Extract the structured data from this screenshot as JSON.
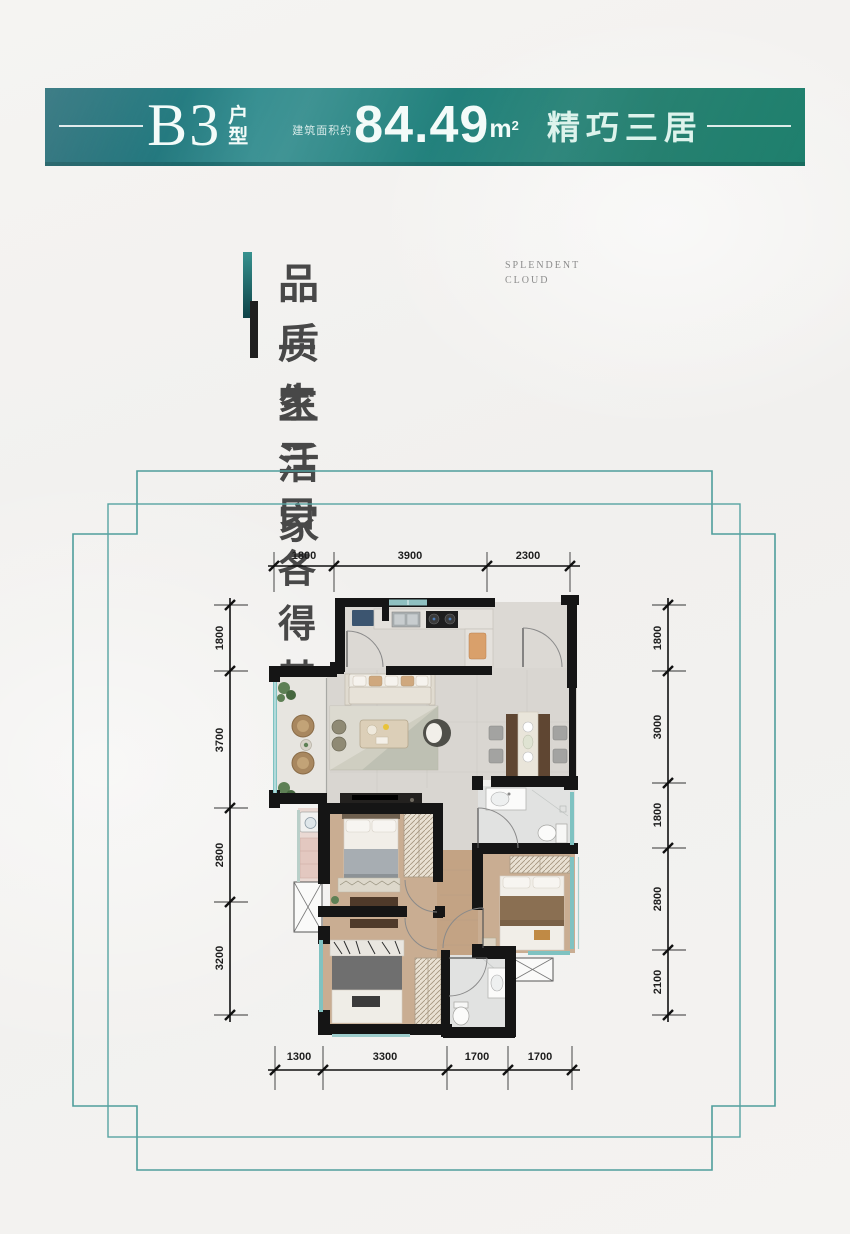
{
  "banner": {
    "unit": "B3",
    "unit_type_top": "户",
    "unit_type_bottom": "型",
    "area_prefix": "建筑面积约",
    "area_value": "84.49",
    "area_unit": "m",
    "area_sup": "2",
    "tagline": "精巧三居"
  },
  "headline": {
    "title": "品质生活家",
    "subtitle_en_line1": "SPLENDENT",
    "subtitle_en_line2": "CLOUD",
    "subtitle": "一家三口各得其乐"
  },
  "floorplan": {
    "dimensions": {
      "top": [
        "1800",
        "3900",
        "2300"
      ],
      "bottom": [
        "1300",
        "3300",
        "1700",
        "1700"
      ],
      "left": [
        "1800",
        "3700",
        "2800",
        "3200"
      ],
      "right": [
        "1800",
        "3000",
        "1800",
        "2800",
        "2100"
      ]
    }
  },
  "colors": {
    "accent_teal": "#2b8587",
    "frame_teal": "#4f9e9c",
    "wall_black": "#151515",
    "wood_floor": "#c9ad92",
    "tile_floor": "#d9d6d1",
    "window_teal": "#7fc2c1"
  }
}
